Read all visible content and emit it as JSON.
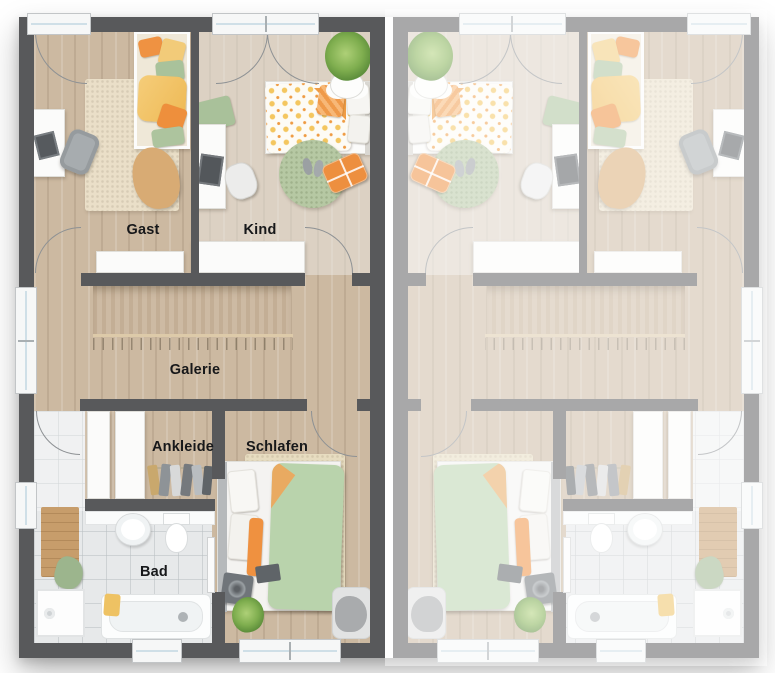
{
  "floor_plan": {
    "rooms": {
      "gast": "Gast",
      "kind": "Kind",
      "galerie": "Galerie",
      "ankleide": "Ankleide",
      "schlafen": "Schlafen",
      "bad": "Bad"
    },
    "palette": {
      "wall": "#58595b",
      "wood_floor": "#ccb9a1",
      "tile_floor": "#e7e9ea",
      "accent_orange": "#ee9140",
      "accent_yellow": "#f2c469",
      "accent_green": "#aecb9d",
      "faded_unit_overlay": "rgba(255,255,255,0.48)"
    }
  }
}
